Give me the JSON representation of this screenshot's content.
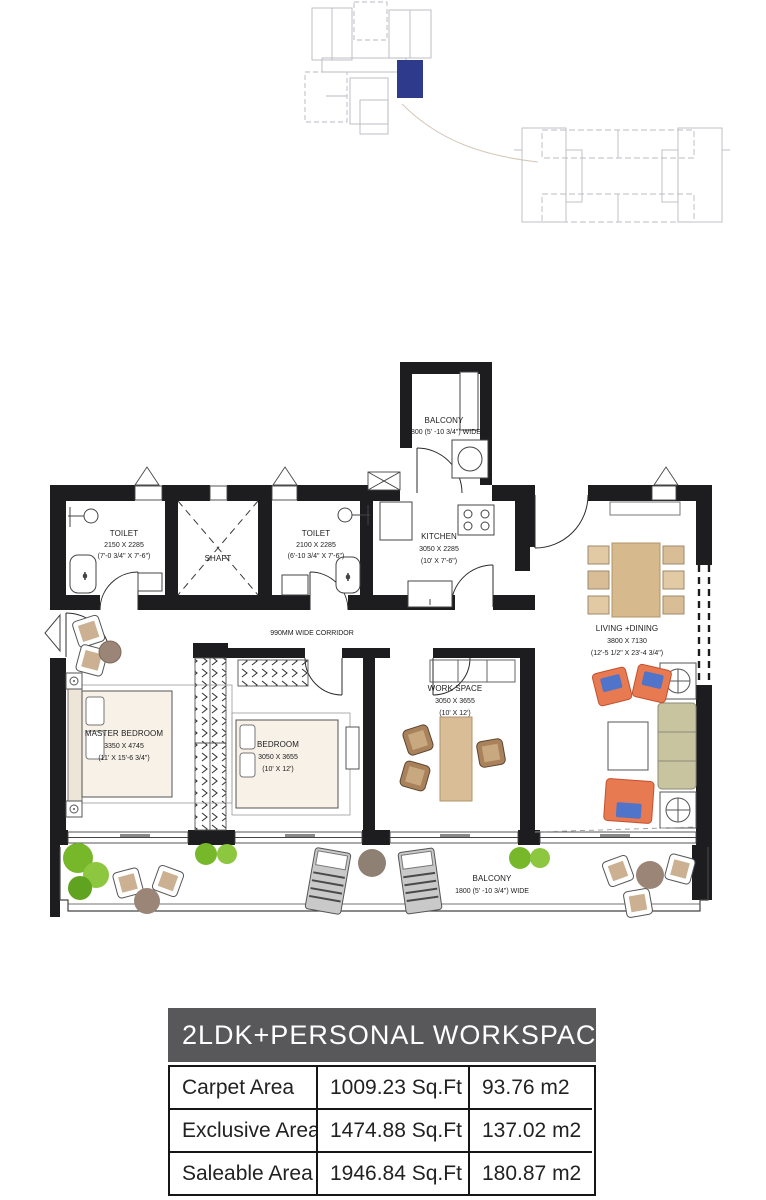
{
  "plan": {
    "toilet1": {
      "name": "TOILET",
      "mm": "2150 X 2285",
      "ft": "(7'-0 3/4\" X 7'-6\")"
    },
    "shaft": {
      "name": "SHAFT"
    },
    "toilet2": {
      "name": "TOILET",
      "mm": "2100 X 2285",
      "ft": "(6'-10 3/4\" X 7'-6\")"
    },
    "kitchen": {
      "name": "KITCHEN",
      "mm": "3050 X 2285",
      "ft": "(10' X 7'-6\")"
    },
    "balcony_top": {
      "name": "BALCONY",
      "width_note": "1800 (5' -10 3/4\") WIDE"
    },
    "corridor": {
      "name": "990MM WIDE CORRIDOR"
    },
    "living": {
      "name": "LIVING +DINING",
      "mm": "3800 X 7130",
      "ft": "(12'-5 1/2\" X 23'-4 3/4\")"
    },
    "master": {
      "name": "MASTER BEDROOM",
      "mm": "3350 X 4745",
      "ft": "(11' X 15'-6 3/4\")"
    },
    "bedroom": {
      "name": "BEDROOM",
      "mm": "3050 X 3655",
      "ft": "(10' X 12')"
    },
    "workspace": {
      "name": "WORK SPACE",
      "mm": "3050 X 3655",
      "ft": "(10' X 12')"
    },
    "balcony_bottom": {
      "name": "BALCONY",
      "width_note": "1800 (5' -10 3/4\") WIDE"
    }
  },
  "summary_table": {
    "title": "2LDK+PERSONAL WORKSPACE (C2)",
    "rows": [
      {
        "label": "Carpet Area",
        "sqft": "1009.23 Sq.Ft",
        "sqm": "93.76 m2"
      },
      {
        "label": "Exclusive Area",
        "sqft": "1474.88 Sq.Ft",
        "sqm": "137.02 m2"
      },
      {
        "label": "Saleable Area",
        "sqft": "1946.84 Sq.Ft",
        "sqm": "180.87 m2"
      }
    ]
  },
  "colors": {
    "unit_highlight": "#2e3a8c",
    "wall": "#1d1d1f",
    "table_header_bg": "#58585a"
  }
}
